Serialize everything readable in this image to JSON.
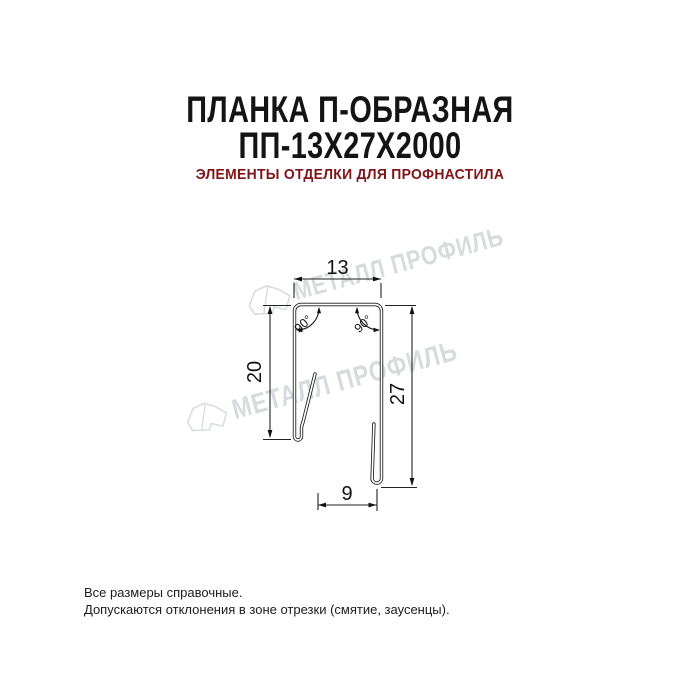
{
  "header": {
    "title_line1": "ПЛАНКА П-ОБРАЗНАЯ",
    "title_line2": "ПП-13Х27Х2000",
    "subtitle": "ЭЛЕМЕНТЫ ОТДЕЛКИ ДЛЯ ПРОФНАСТИЛА"
  },
  "drawing": {
    "dim_top_width": "13",
    "dim_left_height": "20",
    "dim_right_height": "27",
    "dim_bottom_width": "9",
    "angle_left": "90°",
    "angle_right": "90°"
  },
  "watermark": {
    "text": "МЕТАЛЛ ПРОФИЛЬ"
  },
  "footer": {
    "line1": "Все размеры справочные.",
    "line2": "Допускаются отклонения в зоне отрезки (смятие, заусенцы)."
  },
  "colors": {
    "title": "#141414",
    "subtitle_red": "#7e1518",
    "drawing_line": "#1a1a1a",
    "dimension_line": "#222222",
    "watermark": "#d8dbde"
  }
}
